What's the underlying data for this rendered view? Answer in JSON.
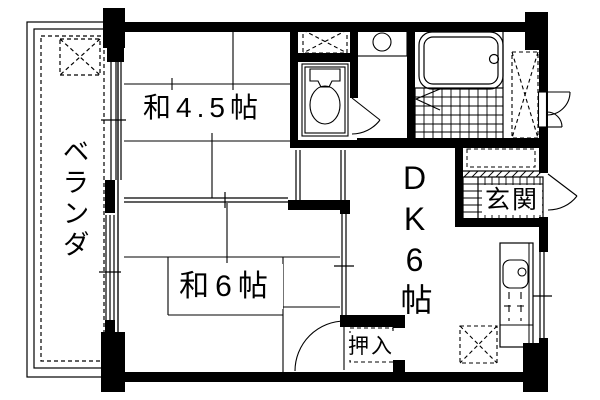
{
  "plan": {
    "background": "#ffffff",
    "wall_color": "#000000",
    "line_color": "#000000",
    "rooms": {
      "veranda": {
        "label": "ベランダ"
      },
      "washitsu45": {
        "label": "和4.5帖"
      },
      "washitsu6": {
        "label": "和6帖"
      },
      "dk": {
        "label": "DK6帖"
      },
      "genkan": {
        "label": "玄関"
      },
      "oshiire": {
        "label": "押入"
      }
    },
    "fixtures": [
      "toilet",
      "washbasin",
      "washing-machine-pan",
      "bathtub",
      "bathroom-tile-floor",
      "folding-bath-door",
      "storage-closet",
      "meter-box-doors",
      "shoe-cabinet",
      "entrance-tile-floor",
      "entrance-door",
      "kitchen-counter",
      "kitchen-sink",
      "gas-stove",
      "refrigerator-space",
      "balcony-pad",
      "sliding-doors",
      "hinged-doors"
    ]
  }
}
